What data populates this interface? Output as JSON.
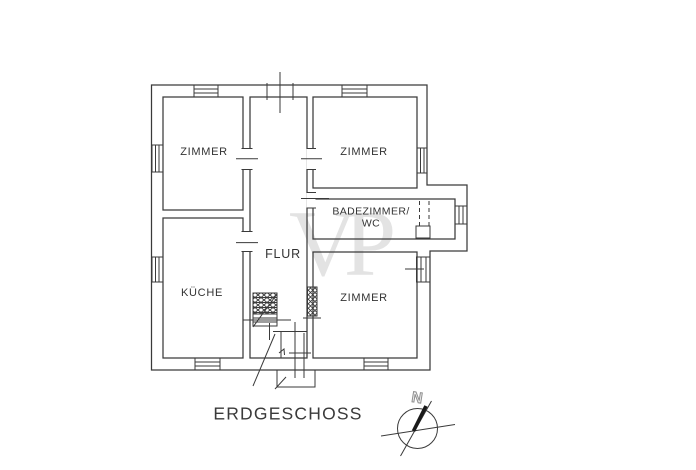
{
  "title": "ERDGESCHOSS",
  "watermark": "VP",
  "compass": {
    "north_label": "N"
  },
  "rooms": {
    "zimmer_top_left": "ZIMMER",
    "zimmer_top_right": "ZIMMER",
    "badezimmer_line1": "BADEZIMMER/",
    "badezimmer_line2": "WC",
    "flur": "FLUR",
    "kueche": "KÜCHE",
    "zimmer_bottom_right": "ZIMMER"
  },
  "colors": {
    "ink": "#3a3a3a",
    "label": "#333333",
    "watermark": "#e3e3e3",
    "background": "#ffffff"
  }
}
